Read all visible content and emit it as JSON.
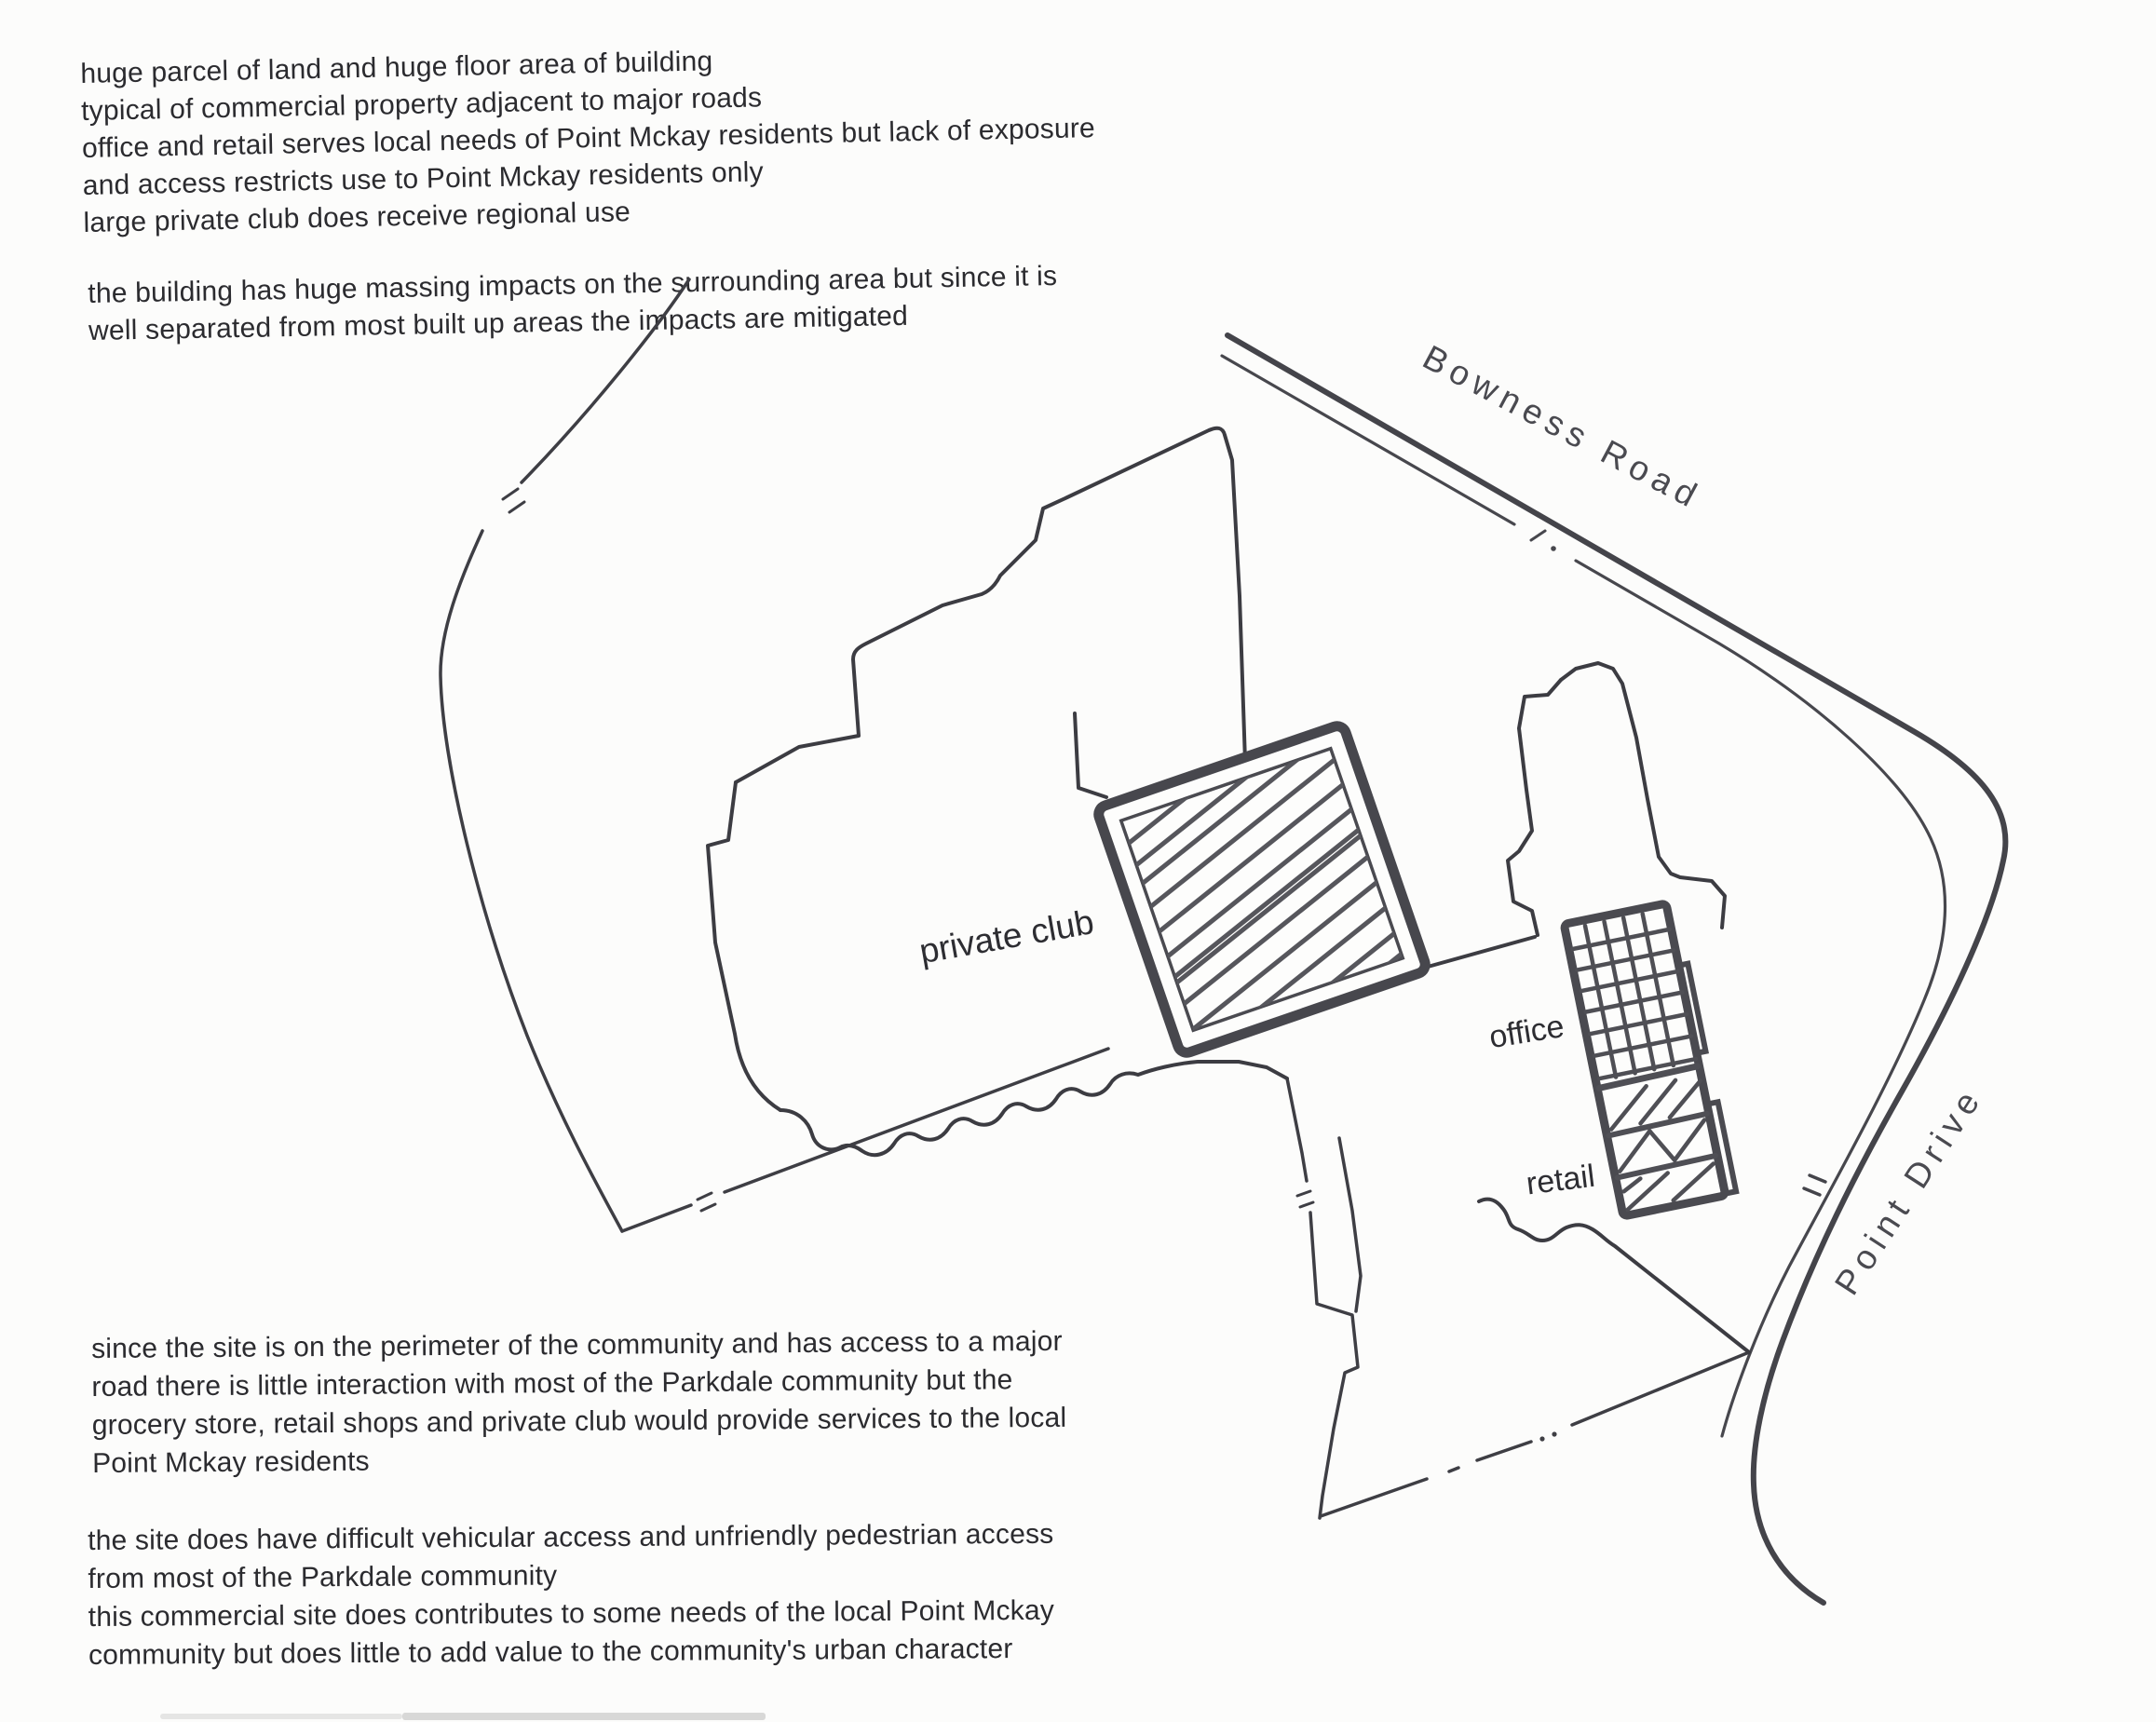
{
  "document": {
    "notes_top": {
      "lines": [
        "huge parcel of land and huge floor area of building",
        "typical of commercial property adjacent to major roads",
        "office and retail serves local needs of Point Mckay residents but lack of exposure",
        "and access restricts use to Point Mckay residents only",
        "large private club does receive regional use"
      ]
    },
    "notes_massing": {
      "lines": [
        "the building has huge massing impacts on the surrounding area but since it is",
        "well separated from most built up areas the impacts are mitigated"
      ]
    },
    "notes_perimeter": {
      "lines": [
        "since the site is on the perimeter of the community and has access to a major",
        "road there is little interaction with most of the Parkdale community but the",
        "grocery store, retail shops and private club would provide services to the local",
        "Point Mckay residents"
      ]
    },
    "notes_access": {
      "lines": [
        "the site does have difficult vehicular access and unfriendly pedestrian access",
        "from most of the Parkdale community",
        "this commercial site does contributes to some needs of the local Point Mckay",
        "community but does little to add value to the community's urban character"
      ]
    }
  },
  "site_plan": {
    "ink_color": "#3e3e44",
    "roads": [
      {
        "name": "Bowness Road"
      },
      {
        "name": "Point Drive"
      }
    ],
    "areas": [
      {
        "name": "private club",
        "pattern": "diagonal-hatch"
      },
      {
        "name": "office",
        "pattern": "grid-hatch"
      },
      {
        "name": "retail",
        "pattern": "diagonal-band-hatch"
      }
    ]
  }
}
